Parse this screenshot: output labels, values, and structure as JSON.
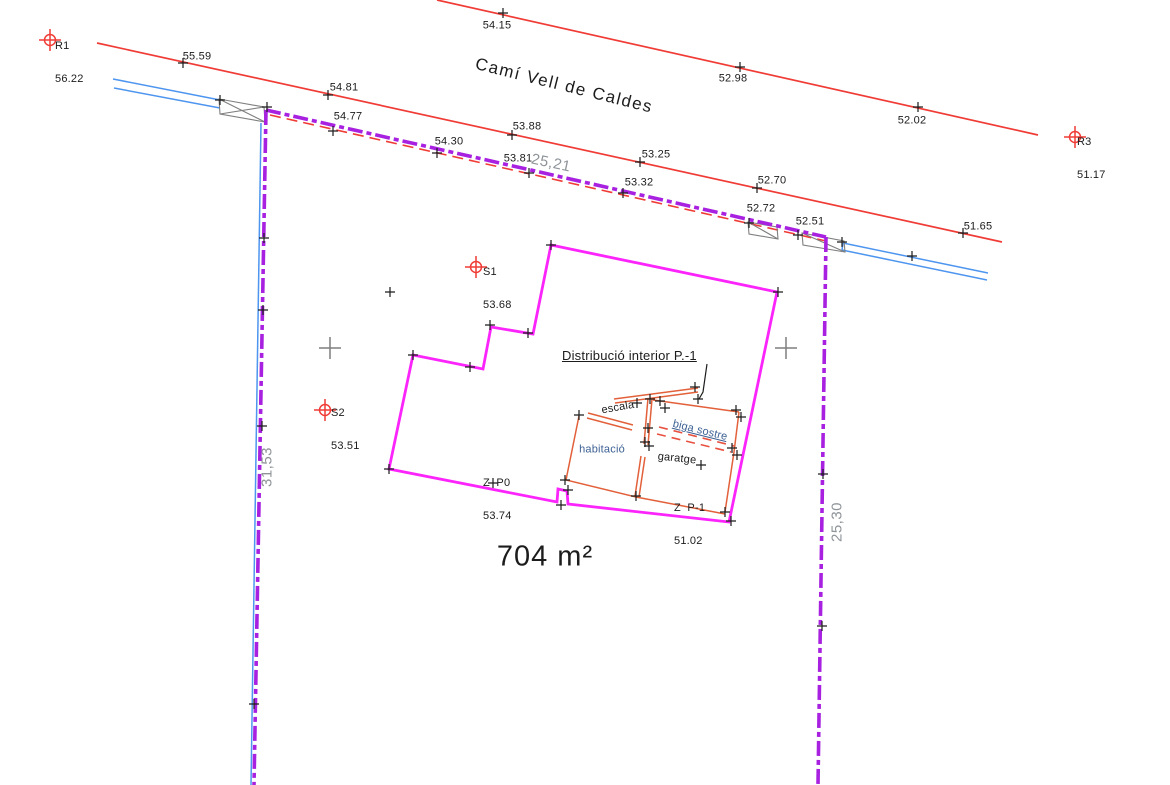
{
  "drawing": {
    "street_name": "Camí Vell de Caldes",
    "area_label": "704 m²",
    "interior_title": "Distribució interior P.-1"
  },
  "rooms": {
    "escala": "escala",
    "habitacio": "habitació",
    "biga_sostre": "biga sostre",
    "garatge": "garatge"
  },
  "reference_points": [
    {
      "name": "R1",
      "elevation": "56.22"
    },
    {
      "name": "R3",
      "elevation": "51.17"
    },
    {
      "name": "S1",
      "elevation": "53.68"
    },
    {
      "name": "S2",
      "elevation": "53.51"
    }
  ],
  "floor_levels": [
    {
      "name": "Z  P0",
      "elevation": "53.74"
    },
    {
      "name": "Z  P-1",
      "elevation": "51.02"
    }
  ],
  "elevations": {
    "road_axis": [
      "54.15",
      "52.98",
      "52.02"
    ],
    "road_edge": [
      "55.59",
      "54.81",
      "53.88",
      "53.25",
      "52.70",
      "51.65"
    ],
    "north_boundary": [
      "54.77",
      "54.30",
      "53.81",
      "53.32",
      "52.72",
      "52.51"
    ]
  },
  "dimensions": {
    "north": "25,21",
    "west": "31,53",
    "east": "25,30"
  },
  "colors": {
    "road": "#f03c36",
    "parcel_boundary": "#a821e0",
    "building": "#fb24fb",
    "service_line": "#4d95ef",
    "interior_walls": "#e2603a",
    "beam_dashed": "#e85040",
    "survey_gray": "#7f7f7f",
    "dimension_text": "#8f9499"
  }
}
